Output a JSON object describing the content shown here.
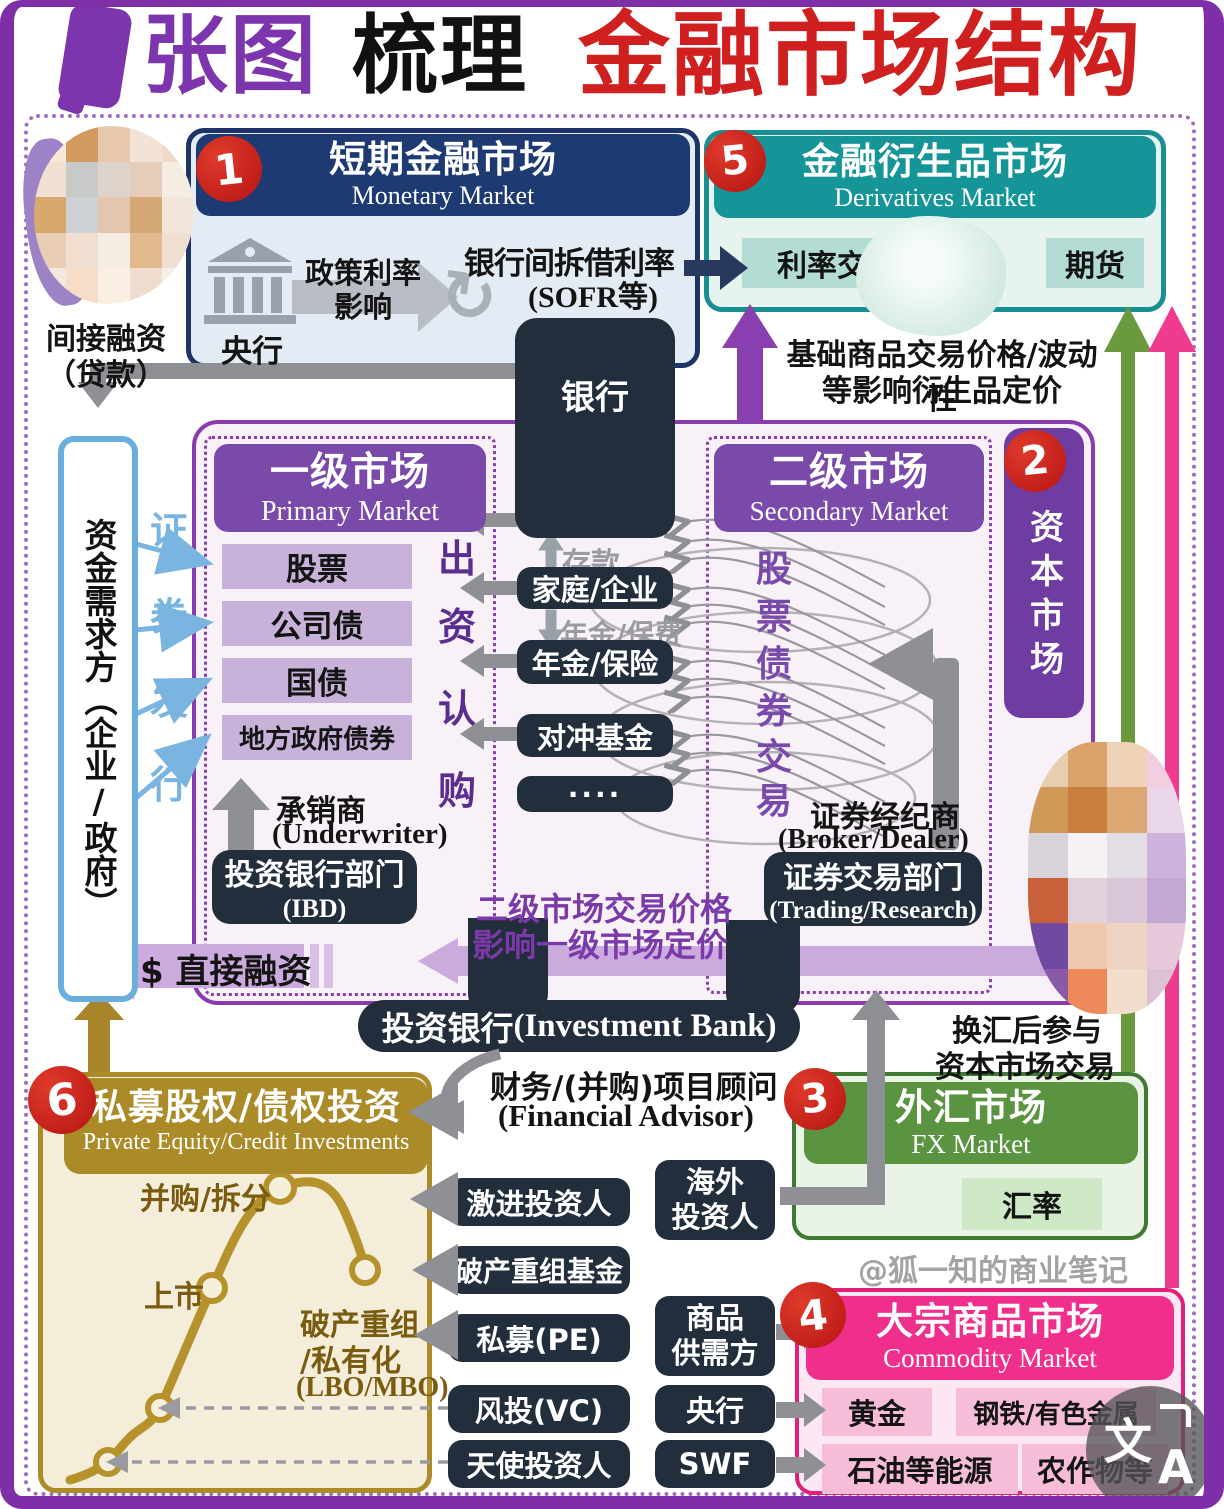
{
  "title": {
    "part1": "张图",
    "part2": "梳理",
    "part3": "金融市场结构"
  },
  "badges": {
    "monetary": "1",
    "capital": "2",
    "fx": "3",
    "commodity": "4",
    "derivatives": "5",
    "pe": "6"
  },
  "icons": {
    "cycle": "↻"
  },
  "monetary": {
    "title": "短期金融市场",
    "subtitle": "Monetary Market",
    "central_bank": "央行",
    "policy_line1": "政策利率",
    "policy_line2": "影响",
    "interbank_rate": "银行间拆借利率",
    "interbank_note": "(SOFR等)"
  },
  "bank_box": {
    "label": "银行"
  },
  "derivatives": {
    "title": "金融衍生品市场",
    "subtitle": "Derivatives Market",
    "item_swap": "利率交换",
    "item_futures": "期货",
    "note_line1": "基础商品交易价格/波动性",
    "note_line2": "等影响衍生品定价"
  },
  "left": {
    "indirect_line1": "间接融资",
    "indirect_line2": "（贷款）",
    "demand_side": "资金需求方（企业/政府）",
    "issuance_chars": [
      "证",
      "券",
      "发",
      "行"
    ],
    "direct_financing": "$ 直接融资"
  },
  "capital": {
    "label": "资本市场"
  },
  "primary": {
    "title": "一级市场",
    "subtitle": "Primary Market",
    "items": [
      "股票",
      "公司债",
      "国债",
      "地方政府债券"
    ],
    "subscribe_chars": [
      "出",
      "资",
      "认",
      "购"
    ],
    "underwriter": "承销商",
    "underwriter_en": "(Underwriter)",
    "ibd": "投资银行部门",
    "ibd_en": "(IBD)"
  },
  "intermediaries": {
    "deposit": "存款",
    "household": "家庭/企业",
    "premium": "年金/保费",
    "annuity": "年金/保险",
    "hedge_fund": "对冲基金",
    "others": "····"
  },
  "secondary": {
    "title": "二级市场",
    "subtitle": "Secondary Market",
    "vertical_chars": [
      "股",
      "票",
      "债",
      "券",
      "交",
      "易"
    ],
    "broker": "证券经纪商",
    "broker_en": "(Broker/Dealer)",
    "trading": "证券交易部门",
    "trading_en": "(Trading/Research)",
    "pricing_line1": "二级市场交易价格",
    "pricing_line2": "影响一级市场定价"
  },
  "investment_bank": {
    "label_cn": "投资银行",
    "label_en": "(Investment Bank)",
    "advisor_line1": "财务/(并购)项目顾问",
    "advisor_line2": "(Financial Advisor)"
  },
  "pe": {
    "title": "私募股权/债权投资",
    "subtitle": "Private Equity/Credit Investments",
    "label_ma": "并购/拆分",
    "label_ipo": "上市",
    "label_lbo1": "破产重组",
    "label_lbo2": "/私有化",
    "label_lbo3": "(LBO/MBO)"
  },
  "investors": {
    "col1": [
      "激进投资人",
      "破产重组基金",
      "私募(PE)",
      "风投(VC)",
      "天使投资人"
    ],
    "col2_overseas_line1": "海外",
    "col2_overseas_line2": "投资人",
    "col2_commodity_line1": "商品",
    "col2_commodity_line2": "供需方",
    "col2_cb": "央行",
    "col2_swf": "SWF"
  },
  "fx": {
    "title": "外汇市场",
    "subtitle": "FX Market",
    "rate": "汇率",
    "note_line1": "换汇后参与",
    "note_line2": "资本市场交易"
  },
  "commodity": {
    "title": "大宗商品市场",
    "subtitle": "Commodity Market",
    "items": [
      "黄金",
      "钢铁/有色金属",
      "石油等能源",
      "农作物等"
    ]
  },
  "watermark": "@狐一知的商业笔记",
  "translate_icon": {
    "char_top": "文",
    "char_bottom": "A"
  },
  "colors": {
    "frame_purple": "#7e2fa8",
    "title_red": "#d01f1f",
    "navy": "#1d3a72",
    "teal": "#169598",
    "purple": "#7a4aab",
    "gold": "#ab8b28",
    "green": "#5a9440",
    "pink": "#f02f8c",
    "dark_box": "#232e3c",
    "badge_red": "#cc1f1f"
  }
}
